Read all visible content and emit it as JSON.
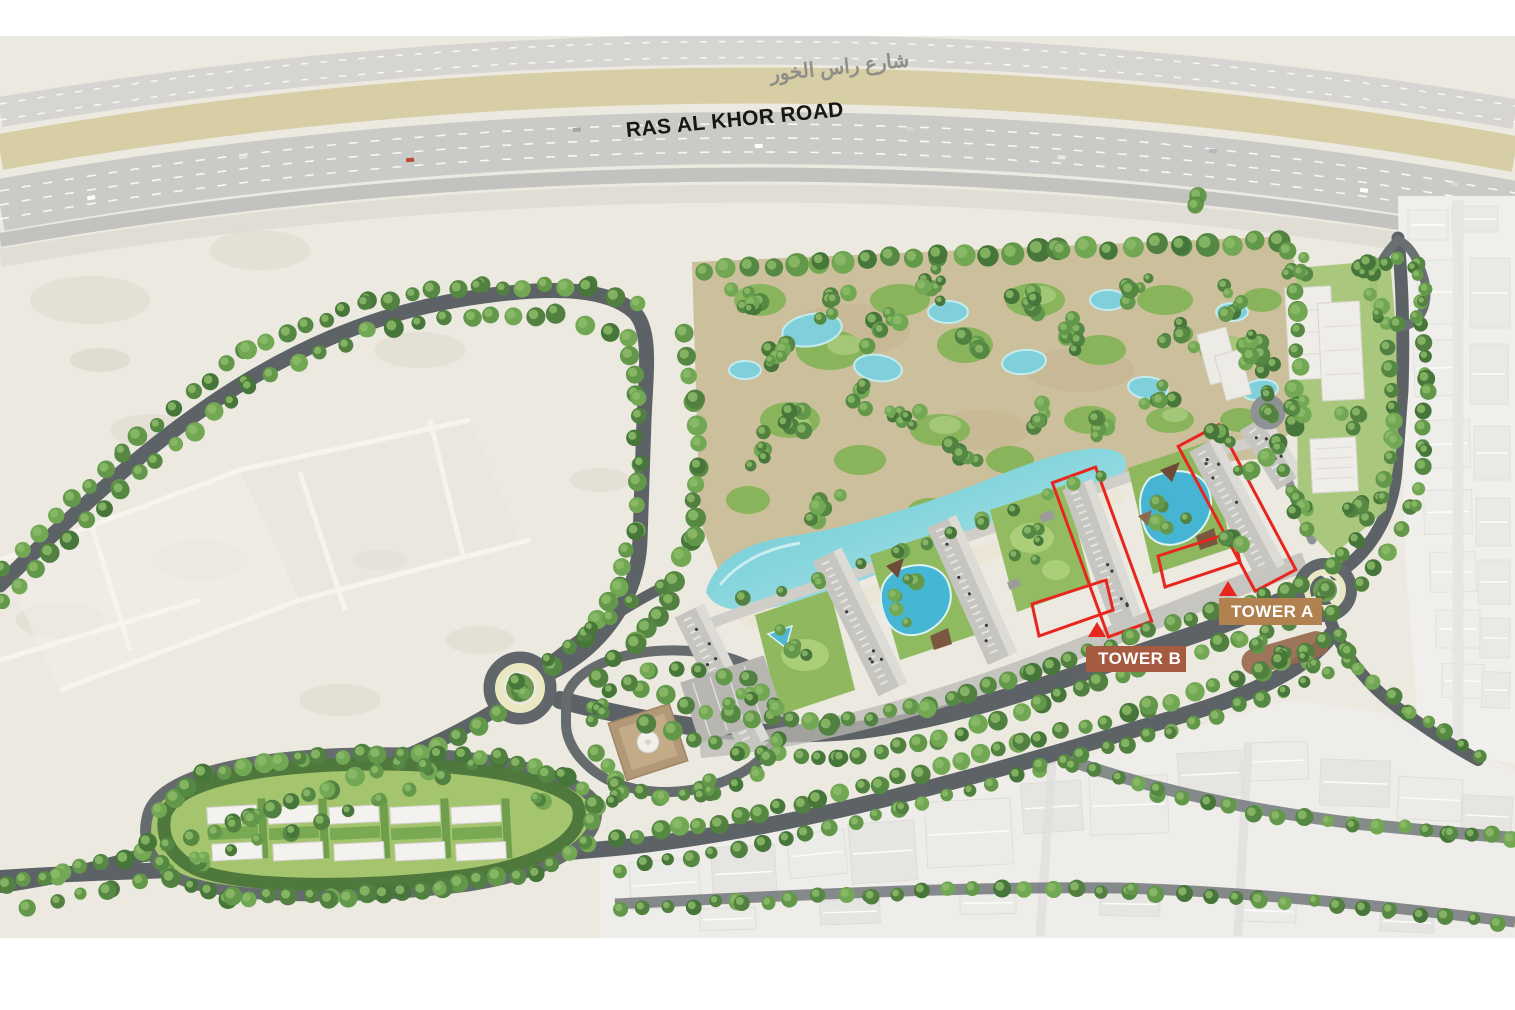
{
  "map": {
    "road_label": "RAS AL KHOR ROAD",
    "road_label_arabic": "شارع راس الخور",
    "markers": {
      "tower_a": {
        "label": "TOWER A",
        "color": "#b1814f"
      },
      "tower_b": {
        "label": "TOWER B",
        "color": "#a65a40"
      }
    },
    "highlight_color": "#e8261e"
  }
}
